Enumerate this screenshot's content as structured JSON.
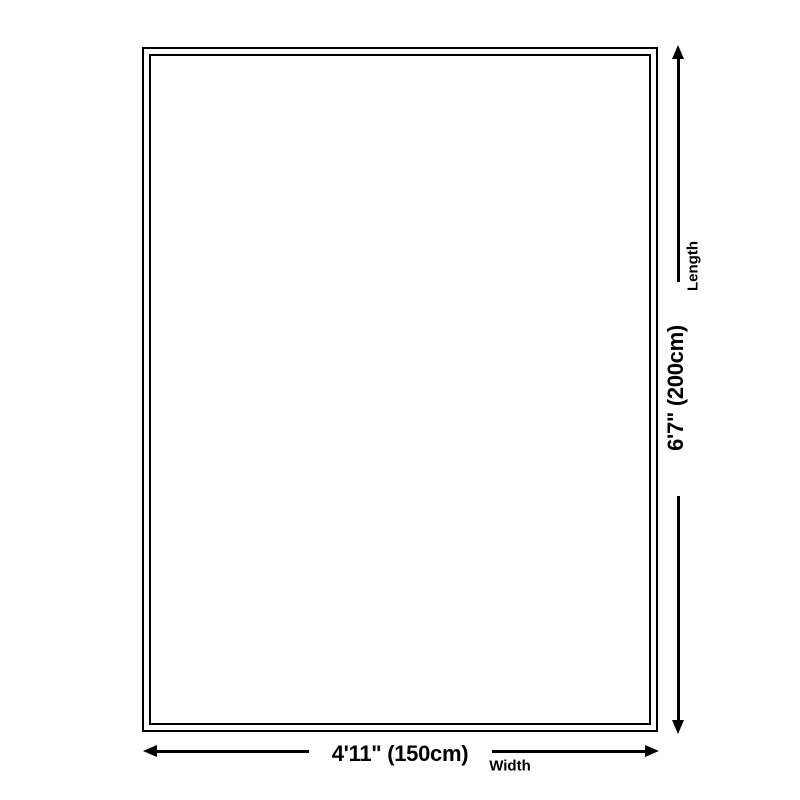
{
  "diagram": {
    "title": "product-dimension-diagram",
    "width_value": "4'11\" (150cm)",
    "width_label": "Width",
    "length_value": "6'7\" (200cm)",
    "length_label": "Length",
    "colors": {
      "line": "#000000",
      "text": "#000000",
      "background": "#ffffff"
    }
  }
}
